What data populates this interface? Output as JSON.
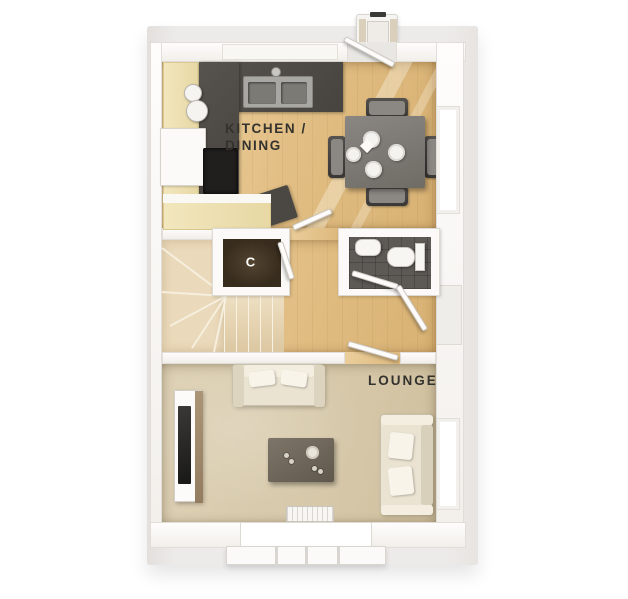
{
  "plan_type": "ground-floor-plan",
  "rooms": {
    "kitchen_dining": {
      "label_line1": "KITCHEN /",
      "label_line2": "DINING"
    },
    "lounge": {
      "label": "LOUNGE"
    },
    "cupboard": {
      "label": "C"
    }
  },
  "fixtures": {
    "kitchen": [
      "worktop",
      "sink",
      "hob",
      "cabinets",
      "appliance"
    ],
    "dining": [
      "table",
      "chairs",
      "plates",
      "napkin"
    ],
    "hall": [
      "stairs",
      "cupboard",
      "front-door"
    ],
    "wc": [
      "basin",
      "toilet"
    ],
    "lounge": [
      "sofa",
      "second-sofa",
      "tv-unit",
      "coffee-table",
      "radiator",
      "bay-window"
    ],
    "exterior": [
      "entrance-porch"
    ]
  },
  "palette": {
    "background": "#ffffff",
    "exterior_slab": "#edebe9",
    "wall": "#fbfaf8",
    "wood_floor": "#e2bf85",
    "carpet": "#d6c8a9",
    "worktop_dark": "#4b4844",
    "cabinet_cream": "#ecddab",
    "cupboard_floor": "#42351f",
    "wc_floor": "#5d5955",
    "stair_tread": "#e6d5b4",
    "label_text": "#34322e",
    "cupboard_label_text": "#ffffff"
  }
}
